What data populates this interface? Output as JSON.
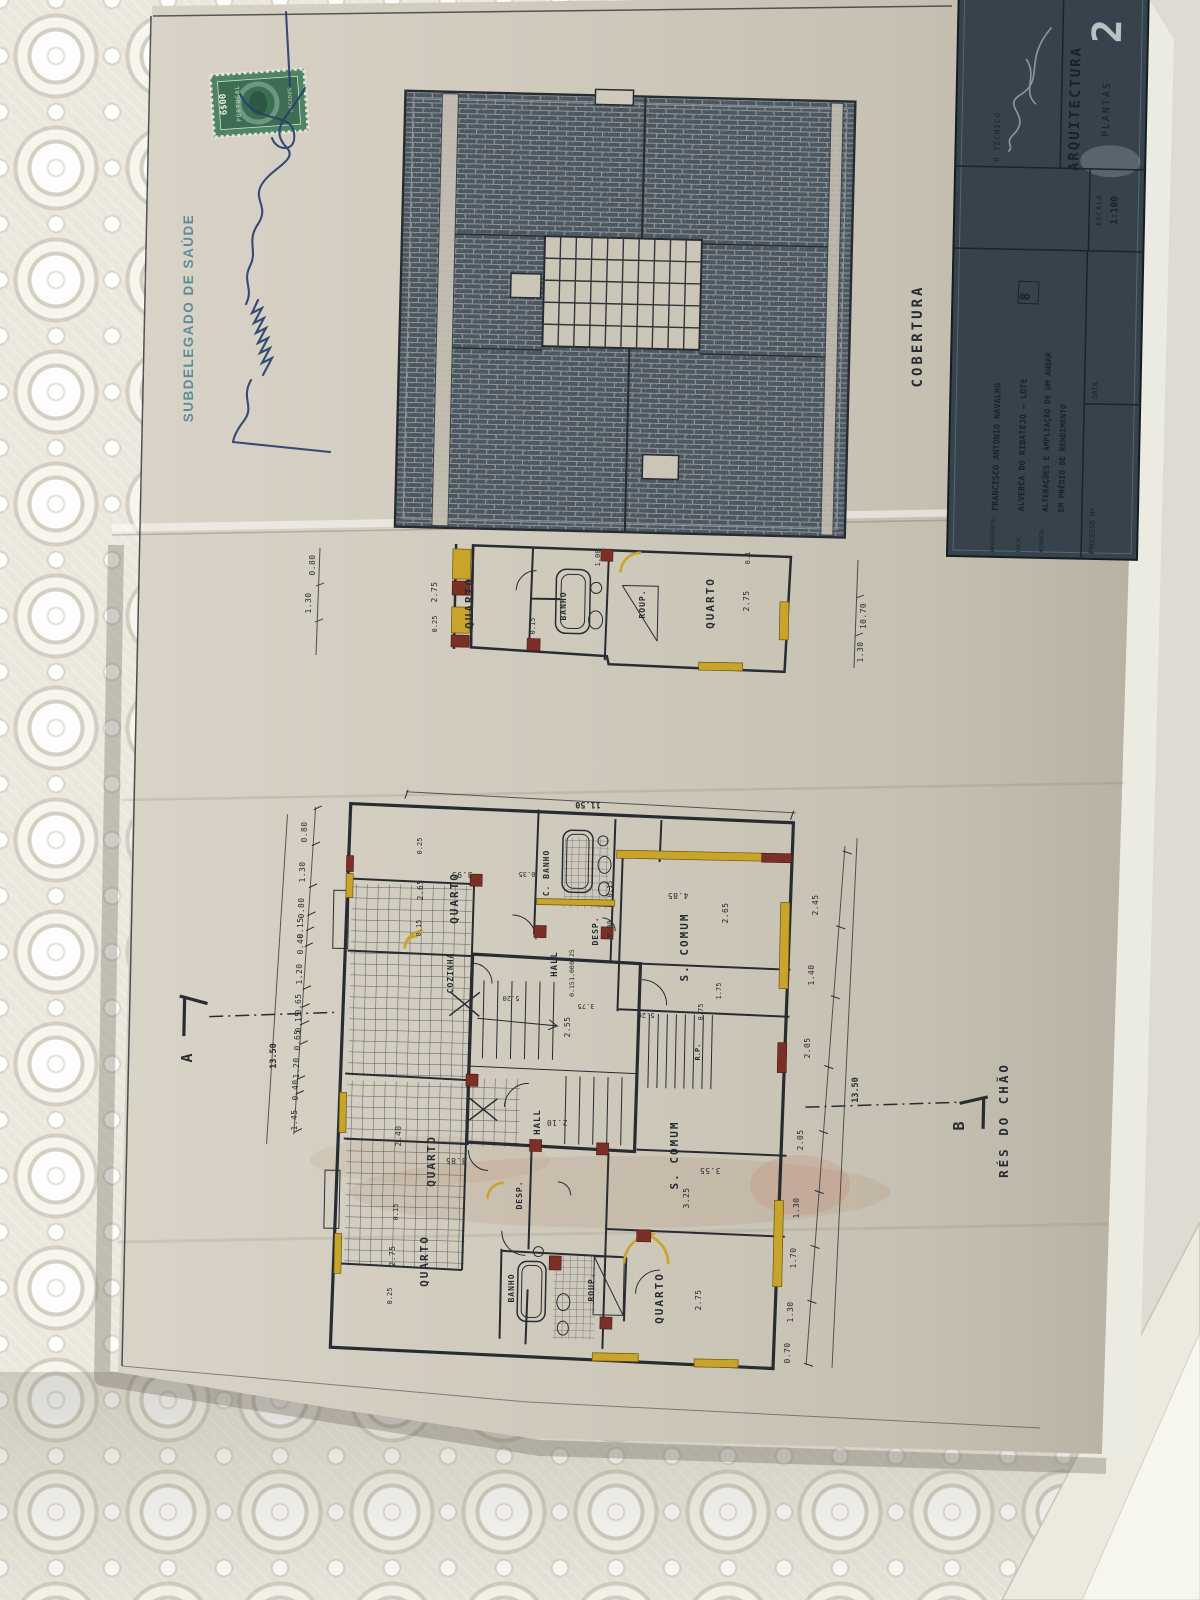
{
  "annotations": {
    "health_stamp": "SUBDELEGADO DE SAÚDE",
    "tax_stamp": {
      "value": "6$00",
      "country": "PORTUGAL",
      "currency": "ESCUDOS"
    }
  },
  "roof_plan": {
    "title": "COBERTURA"
  },
  "upper_plan": {
    "rooms": {
      "quarto_left": "QUARTO",
      "banho": "BANHO",
      "roup": "ROUP.",
      "quarto_right": "QUARTO"
    },
    "dims": [
      "0.25",
      "2.75",
      "0.15",
      "1.00",
      "0.1",
      "2.75",
      "0.80",
      "1.30",
      "10.70",
      "1.30"
    ]
  },
  "main_plan": {
    "title": "RÉS DO CHÃO",
    "section_markers": {
      "a": "A",
      "b": "B"
    },
    "rooms": {
      "quarto_tl": "QUARTO",
      "cozinha": "COZINHA",
      "c_banho_top": "C. BANHO",
      "desp_top": "DESP.",
      "hall_top": "HALL",
      "s_comum_top": "S. COMUM",
      "quarto_ml": "QUARTO",
      "quarto_bl": "QUARTO",
      "banho_bot": "BANHO",
      "roup_bot": "ROUP.",
      "s_comum_bot": "S. COMUM",
      "quarto_br": "QUARTO",
      "hall_bot": "HALL",
      "desp_bot": "DESP.",
      "rp": "R.P."
    },
    "dims": {
      "top_total": "11.50",
      "left_total": "13.50",
      "right_total": "13.50",
      "left_chain": [
        "0.80",
        "1.30",
        "0.80",
        "0.15",
        "0.40",
        "1.20",
        "0.65",
        "0.15",
        "0.65",
        "1.20",
        "0.40",
        "1.45"
      ],
      "right_chain_outer": [
        "2.45",
        "1.40",
        "2.05"
      ],
      "right_chain_inner": [
        "2.05",
        "1.30",
        "1.70",
        "1.30",
        "0.70"
      ],
      "room_dims": {
        "quarto_tl_w": "2.65",
        "quarto_tl_l": "3.95",
        "quarto_tl_o": "0.35",
        "quarto_tl_t1": "0.25",
        "quarto_tl_t2": "0.15",
        "s_comum_top_l": "4.85",
        "s_comum_top_w": "2.65",
        "s_comum_top_o": "0.15",
        "quarto_ml_w": "2.40",
        "quarto_ml_l": "3.85",
        "quarto_bl_w": "2.75",
        "quarto_bl_o1": "0.15",
        "quarto_bl_o2": "0.25",
        "s_comum_bot_l": "3.55",
        "s_comum_bot_w": "3.25",
        "quarto_br_w": "2.75",
        "hall_bot_w": "2.10",
        "stairs_w": "2.55",
        "wing_a": "5.20",
        "wing_b": "5.20",
        "wing_c": "3.75",
        "desp_w": "0.90",
        "op1": "1.75",
        "op2": "0.75",
        "hall_stack": [
          "0.25",
          "1.00",
          "0.15"
        ]
      }
    }
  },
  "title_block": {
    "sheet_number": "2",
    "technician_label": "O TÉCNICO",
    "discipline": "ARQUITECTURA",
    "drawing_type": "PLANTAS",
    "scale_label": "ESCALA",
    "scale_value": "1:100",
    "requester_label": "REQUERENTE:",
    "requester": "FRANCISCO ANTÓNIO NAVALHO",
    "location_label": "LOCAL:",
    "location": "ALVERCA DO RIBATEJO — LOTE",
    "lot_number": "8",
    "subject_label": "ASSUNTO:",
    "subject_line1": "ALTERAÇÕES E AMPLIAÇÃO DE UM ANDAR",
    "subject_line2": "EM PRÉDIO DE RENDIMENTO",
    "process_label": "PROCESSO Nº",
    "date_label": "DATA"
  },
  "colors": {
    "ink": "#272c33",
    "paper": "#cdc7ba",
    "highlight_new": "#c9a42b",
    "highlight_old": "#7b3026",
    "title_block_bg": "#36434c",
    "stamp_teal": "#47808f",
    "signature_ink": "#27406e",
    "tax_stamp_green": "#45795f"
  }
}
